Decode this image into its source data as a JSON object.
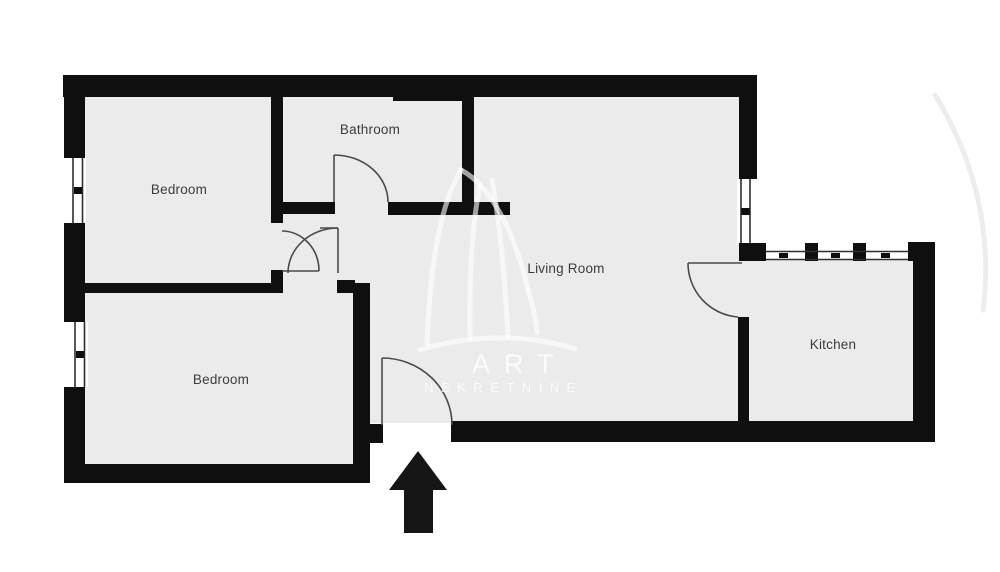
{
  "plan": {
    "title": "Apartment floor plan",
    "rooms": [
      {
        "id": "bedroom-top",
        "label": "Bedroom"
      },
      {
        "id": "bathroom",
        "label": "Bathroom"
      },
      {
        "id": "living-room",
        "label": "Living Room"
      },
      {
        "id": "bedroom-bottom",
        "label": "Bedroom"
      },
      {
        "id": "kitchen",
        "label": "Kitchen"
      }
    ],
    "watermark": {
      "line1": "ART",
      "line2": "NEKRETNINE"
    },
    "colors": {
      "wall": "#0f0f0f",
      "floor": "#ebebeb",
      "background": "#ffffff",
      "label": "#3c3c3c",
      "door_stroke": "#4a4a4a",
      "window_stroke": "#2f2f2f",
      "arrow": "#161616"
    }
  }
}
